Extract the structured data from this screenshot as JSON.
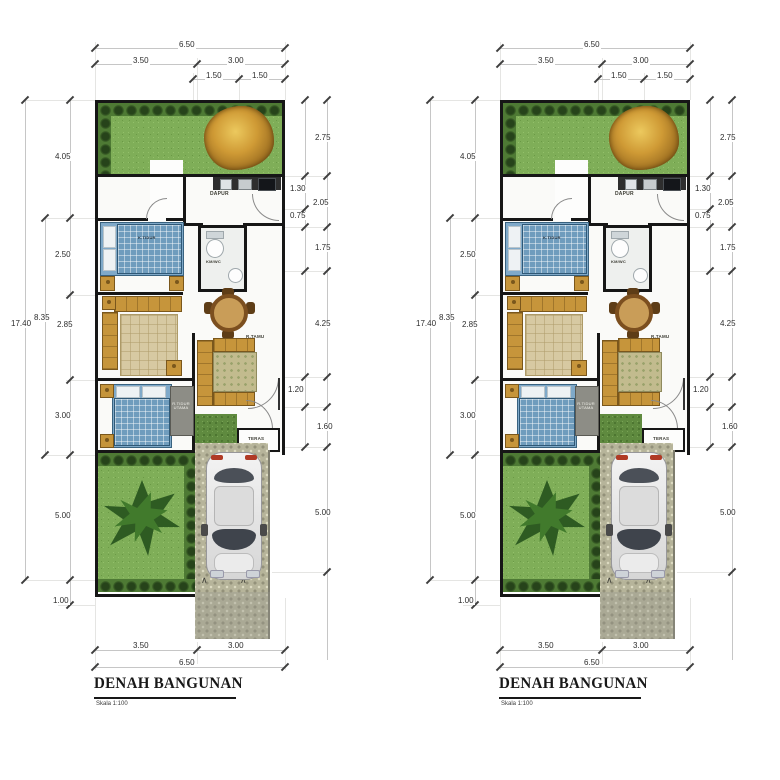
{
  "plan": {
    "title": "DENAH BANGUNAN",
    "scale": "Skala 1:100",
    "dims": {
      "top_total": "6.50",
      "top_left": "3.50",
      "top_right": "3.00",
      "top_s1": "1.50",
      "top_s2": "1.50",
      "left_total": "17.40",
      "left_mid": "8.35",
      "left_1": "4.05",
      "left_2": "2.50",
      "left_3": "2.85",
      "left_4": "3.00",
      "left_5": "5.00",
      "left_6": "1.00",
      "right_1": "2.75",
      "right_2": "1.30",
      "right_3": "2.05",
      "right_4": "0.75",
      "right_5": "1.75",
      "right_6": "4.25",
      "right_7": "1.20",
      "right_8": "1.60",
      "right_9": "5.00",
      "bottom_left": "3.50",
      "bottom_right": "3.00",
      "bottom_total": "6.50"
    },
    "rooms": {
      "kitchen": "DAPUR",
      "bedroom": "K.TIDUR",
      "bathroom": "KM/WC",
      "living": "R.TAMU",
      "master_line1": "R.TIDUR",
      "master_line2": "UTAMA",
      "porch": "TERAS"
    },
    "colors": {
      "grass": "#7fae58",
      "shrub_border": "#26431a",
      "gold_shrub": "#cf9a35",
      "wall": "#161616",
      "paver": "#b6b49a",
      "dim_text": "#2d2d2d",
      "bed_blue": "#6f9cbd",
      "sofa_gold": "#c6953b",
      "car_glass": "#3f444c"
    }
  }
}
